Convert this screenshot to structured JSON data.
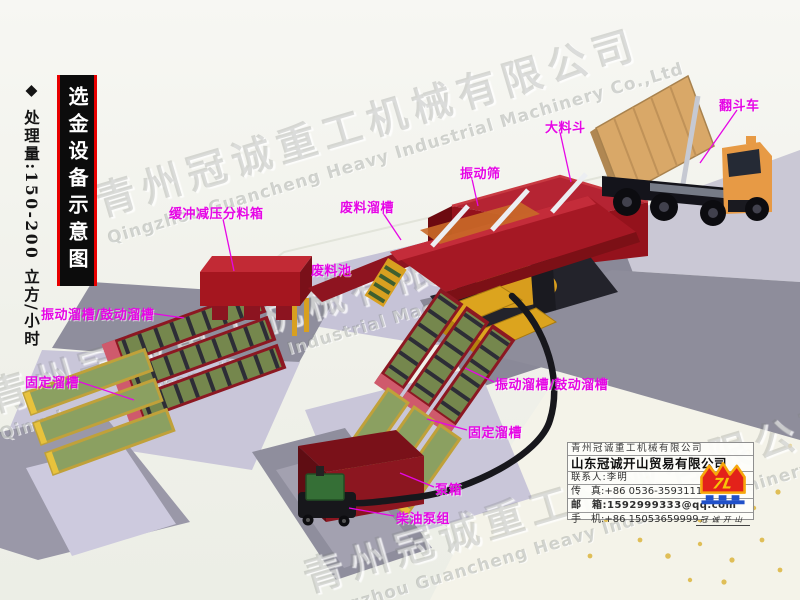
{
  "page": {
    "title": "选金设备示意图"
  },
  "title_bar": {
    "text": "选金设备示意图"
  },
  "capacity_note": {
    "text": "◆ 处理量:150-200 立方/小时"
  },
  "watermark": {
    "cn": "青州冠诚重工机械有限公司",
    "en": "Qingzhou Guancheng Heavy Industrial Machinery Co.,Ltd"
  },
  "labels": [
    {
      "id": "dump-truck",
      "text": "翻斗车"
    },
    {
      "id": "big-hopper",
      "text": "大料斗"
    },
    {
      "id": "vibrating-screen",
      "text": "振动筛"
    },
    {
      "id": "waste-chute",
      "text": "废料溜槽"
    },
    {
      "id": "buffer-divider-box",
      "text": "缓冲减压分料箱"
    },
    {
      "id": "waste-pool",
      "text": "废料池"
    },
    {
      "id": "vibrating-sluice-left",
      "text": "振动溜槽/鼓动溜槽"
    },
    {
      "id": "fixed-sluice-left",
      "text": "固定溜槽"
    },
    {
      "id": "vibrating-sluice-right",
      "text": "振动溜槽/鼓动溜槽"
    },
    {
      "id": "fixed-sluice-right",
      "text": "固定溜槽"
    },
    {
      "id": "pump-box",
      "text": "泵箱"
    },
    {
      "id": "diesel-pump-unit",
      "text": "柴油泵组"
    }
  ],
  "contact_card": {
    "company_primary": "青州冠诚重工机械有限公司",
    "company_secondary": "山东冠诚开山贸易有限公司",
    "rows": [
      {
        "label": "联系人:",
        "value": "李明"
      },
      {
        "label": "传　真:",
        "value": "+86 0536-3593111"
      },
      {
        "label": "邮　箱:",
        "value": "1592999333@qq.com"
      },
      {
        "label": "手　机:",
        "value": "+86 15053659999"
      }
    ],
    "logo": {
      "mark": "7L",
      "caption": "冠诚开山"
    }
  },
  "colors": {
    "label_magenta": "#e606e6",
    "equipment_red": "#a5161f",
    "machine_yellow": "#d8a020",
    "sluice_green": "#75874d",
    "title_accent_red": "#e80000"
  }
}
